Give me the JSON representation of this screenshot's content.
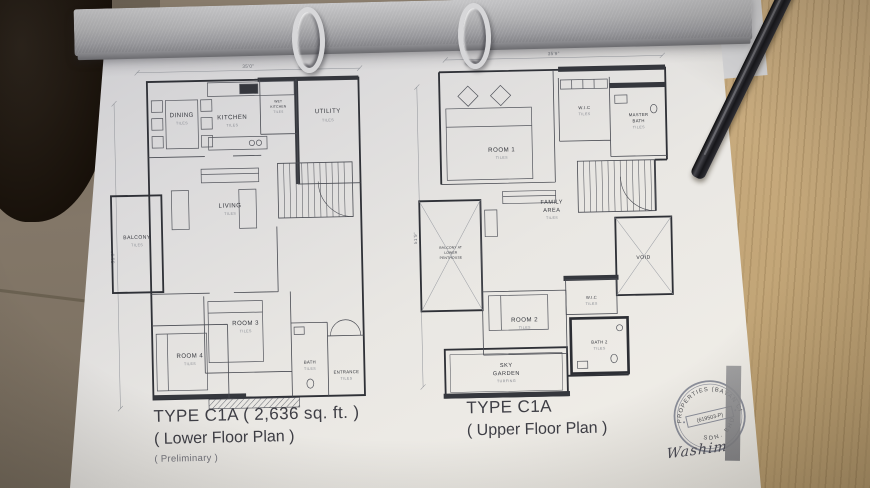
{
  "colors": {
    "paper": "#e9e7e3",
    "binder": "#aaaaae",
    "wood_table": "#c3a678",
    "plan_ink": "#3a3c42",
    "stamp_ink": "#7d8190"
  },
  "lower_plan": {
    "dim_top": "35'0\"",
    "dim_side": "51'9\"",
    "rooms": {
      "dining": {
        "label": "DINING",
        "sub": "TILES"
      },
      "kitchen": {
        "label": "KITCHEN",
        "sub": "TILES"
      },
      "wet_kitchen": {
        "line1": "WET",
        "line2": "KITCHEN",
        "sub": "TILES"
      },
      "utility": {
        "label": "UTILITY",
        "sub": "TILES"
      },
      "balcony": {
        "label": "BALCONY",
        "sub": "TILES"
      },
      "living": {
        "label": "LIVING",
        "sub": "TILES"
      },
      "room3": {
        "label": "ROOM 3",
        "sub": "TILES"
      },
      "room4": {
        "label": "ROOM 4",
        "sub": "TILES"
      },
      "bath": {
        "label": "BATH",
        "sub": "TILES"
      },
      "entrance": {
        "label": "ENTRANCE",
        "sub": "TILES"
      }
    },
    "title_line1": "TYPE C1A ( 2,636 sq. ft. )",
    "title_line2": "( Lower Floor Plan )",
    "title_line3": "( Preliminary )"
  },
  "upper_plan": {
    "dim_top": "35'9\"",
    "dim_side": "51'9\"",
    "rooms": {
      "room1": {
        "label": "ROOM 1",
        "sub": "TILES"
      },
      "wic_master": {
        "label": "W.I.C",
        "sub": "TILES"
      },
      "master_bath": {
        "line1": "MASTER",
        "line2": "BATH",
        "sub": "TILES"
      },
      "family_area": {
        "line1": "FAMILY",
        "line2": "AREA",
        "sub": "TILES"
      },
      "void": {
        "label": "VOID"
      },
      "balcony_penthouse": {
        "line1": "BALCONY AT",
        "line2": "LOWER",
        "line3": "PENTHOUSE"
      },
      "room2": {
        "label": "ROOM 2",
        "sub": "TILES"
      },
      "wic2": {
        "label": "W.I.C",
        "sub": "TILES"
      },
      "bath2": {
        "label": "BATH 2",
        "sub": "TILES"
      },
      "sky_garden": {
        "line1": "SKY",
        "line2": "GARDEN",
        "sub": "TURFING"
      }
    },
    "title_line1": "TYPE C1A",
    "title_line2": "( Upper Floor Plan )"
  },
  "stamp": {
    "arc_top": "PROPERTIES (BAYAN CITY)",
    "arc_bottom": "SDN. BHD.",
    "center": "(619503-P)"
  },
  "signature": "Washim"
}
